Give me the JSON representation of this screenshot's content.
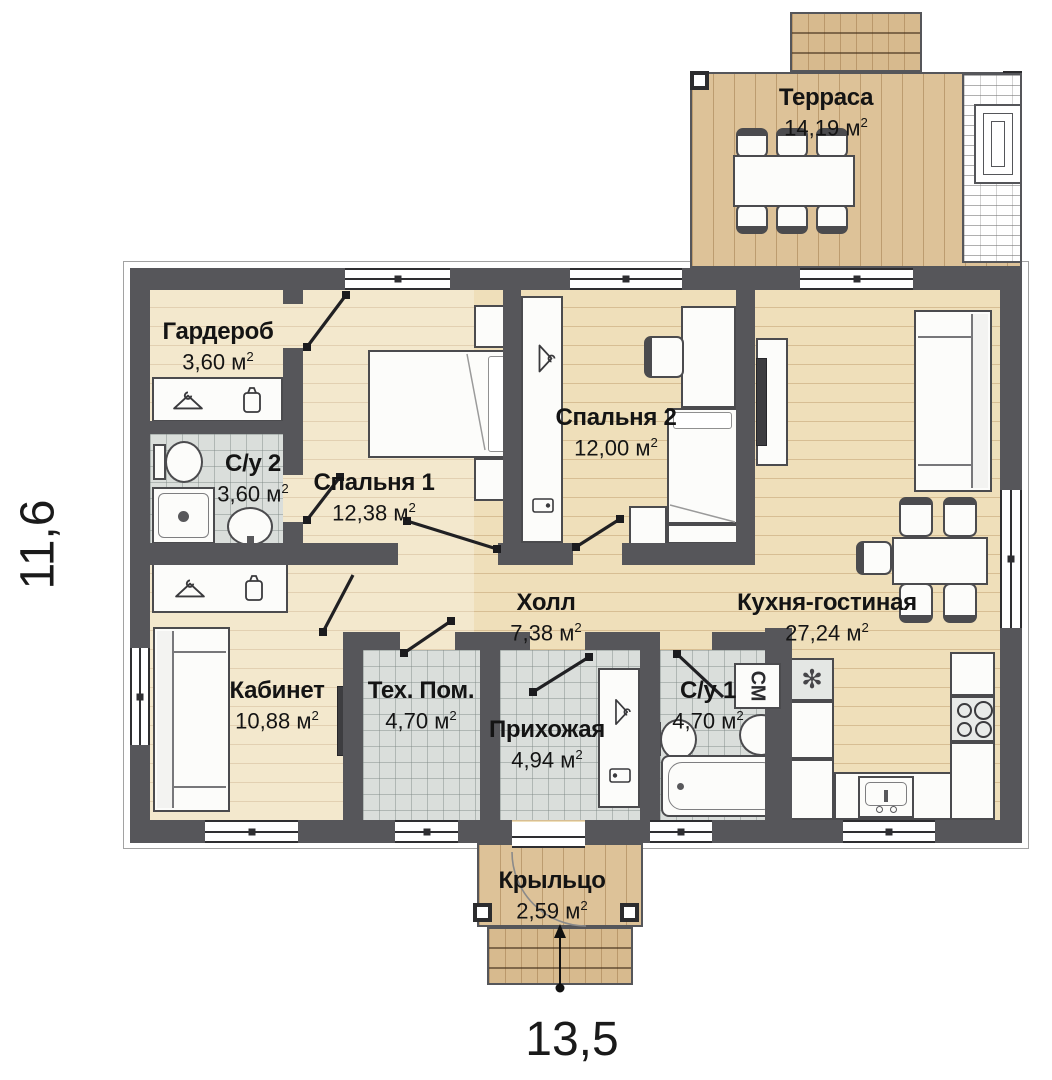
{
  "meta": {
    "unit": "м",
    "sup": "2"
  },
  "dimensions": {
    "height_label": "11,6",
    "width_label": "13,5"
  },
  "rooms": {
    "terrace": {
      "name": "Терраса",
      "area": "14,19"
    },
    "wardrobe": {
      "name": "Гардероб",
      "area": "3,60"
    },
    "bathroom2": {
      "name": "С/у 2",
      "area": "3,60"
    },
    "bedroom1": {
      "name": "Спальня 1",
      "area": "12,38"
    },
    "bedroom2": {
      "name": "Спальня 2",
      "area": "12,00"
    },
    "hall": {
      "name": "Холл",
      "area": "7,38"
    },
    "kitchen_living": {
      "name": "Кухня-гостиная",
      "area": "27,24"
    },
    "office": {
      "name": "Кабинет",
      "area": "10,88"
    },
    "tech": {
      "name": "Тех. Пом.",
      "area": "4,70"
    },
    "entry": {
      "name": "Прихожая",
      "area": "4,94"
    },
    "bathroom1": {
      "name": "С/у 1",
      "area": "4,70"
    },
    "porch": {
      "name": "Крыльцо",
      "area": "2,59"
    }
  },
  "appliances": {
    "washing_machine": "СМ"
  },
  "colors": {
    "wall": "#56565a",
    "wood": "#efdfba",
    "terrace_wood": "#ddc298",
    "tile": "#dadedb"
  }
}
